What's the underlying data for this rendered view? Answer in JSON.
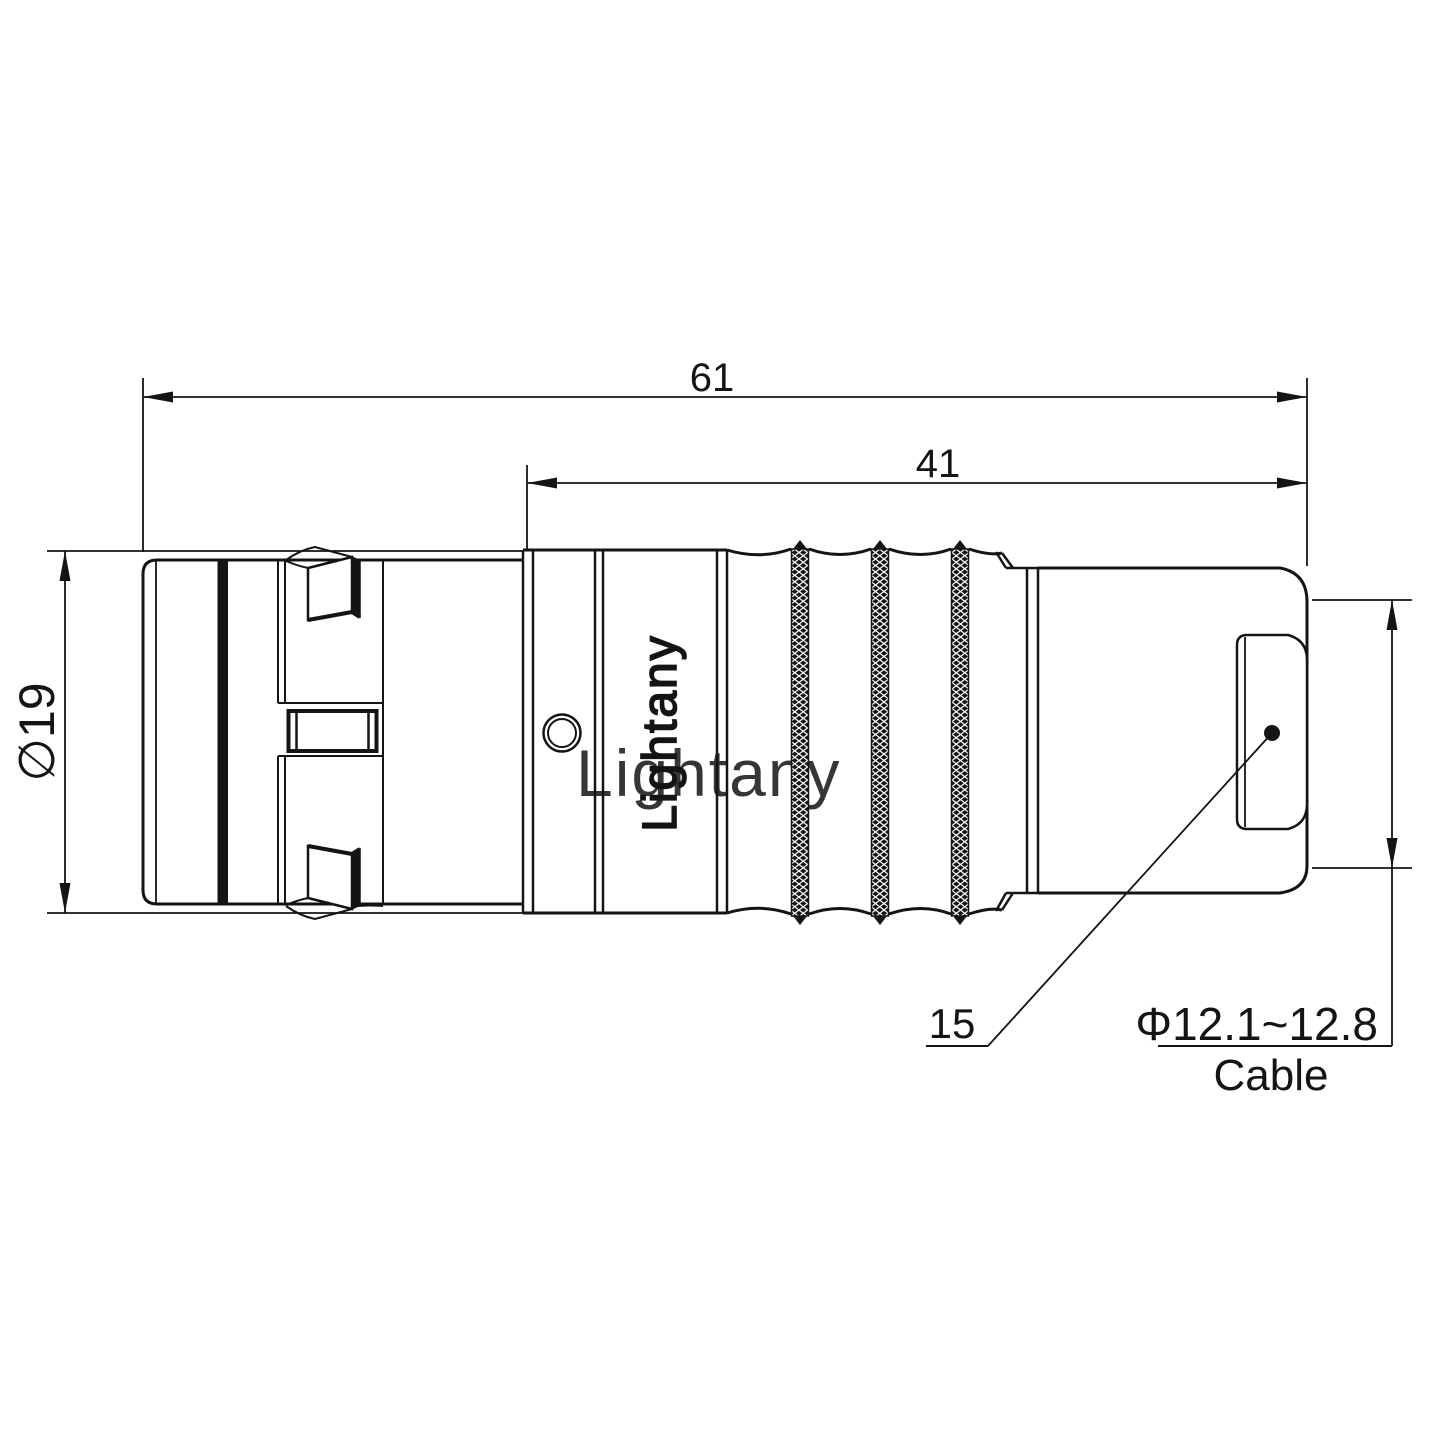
{
  "drawing": {
    "dimensions": {
      "overall_length": "61",
      "rear_section_length": "41",
      "outer_diameter": "∅19",
      "cable_diameter_range": "Φ12.1~12.8",
      "cable_label": "Cable",
      "part_callout": "15"
    },
    "branding": {
      "shell_text": "Lightany",
      "watermark_text": "Lightany"
    },
    "colors": {
      "line": "#141414",
      "watermark": "#f1a9a9"
    }
  }
}
